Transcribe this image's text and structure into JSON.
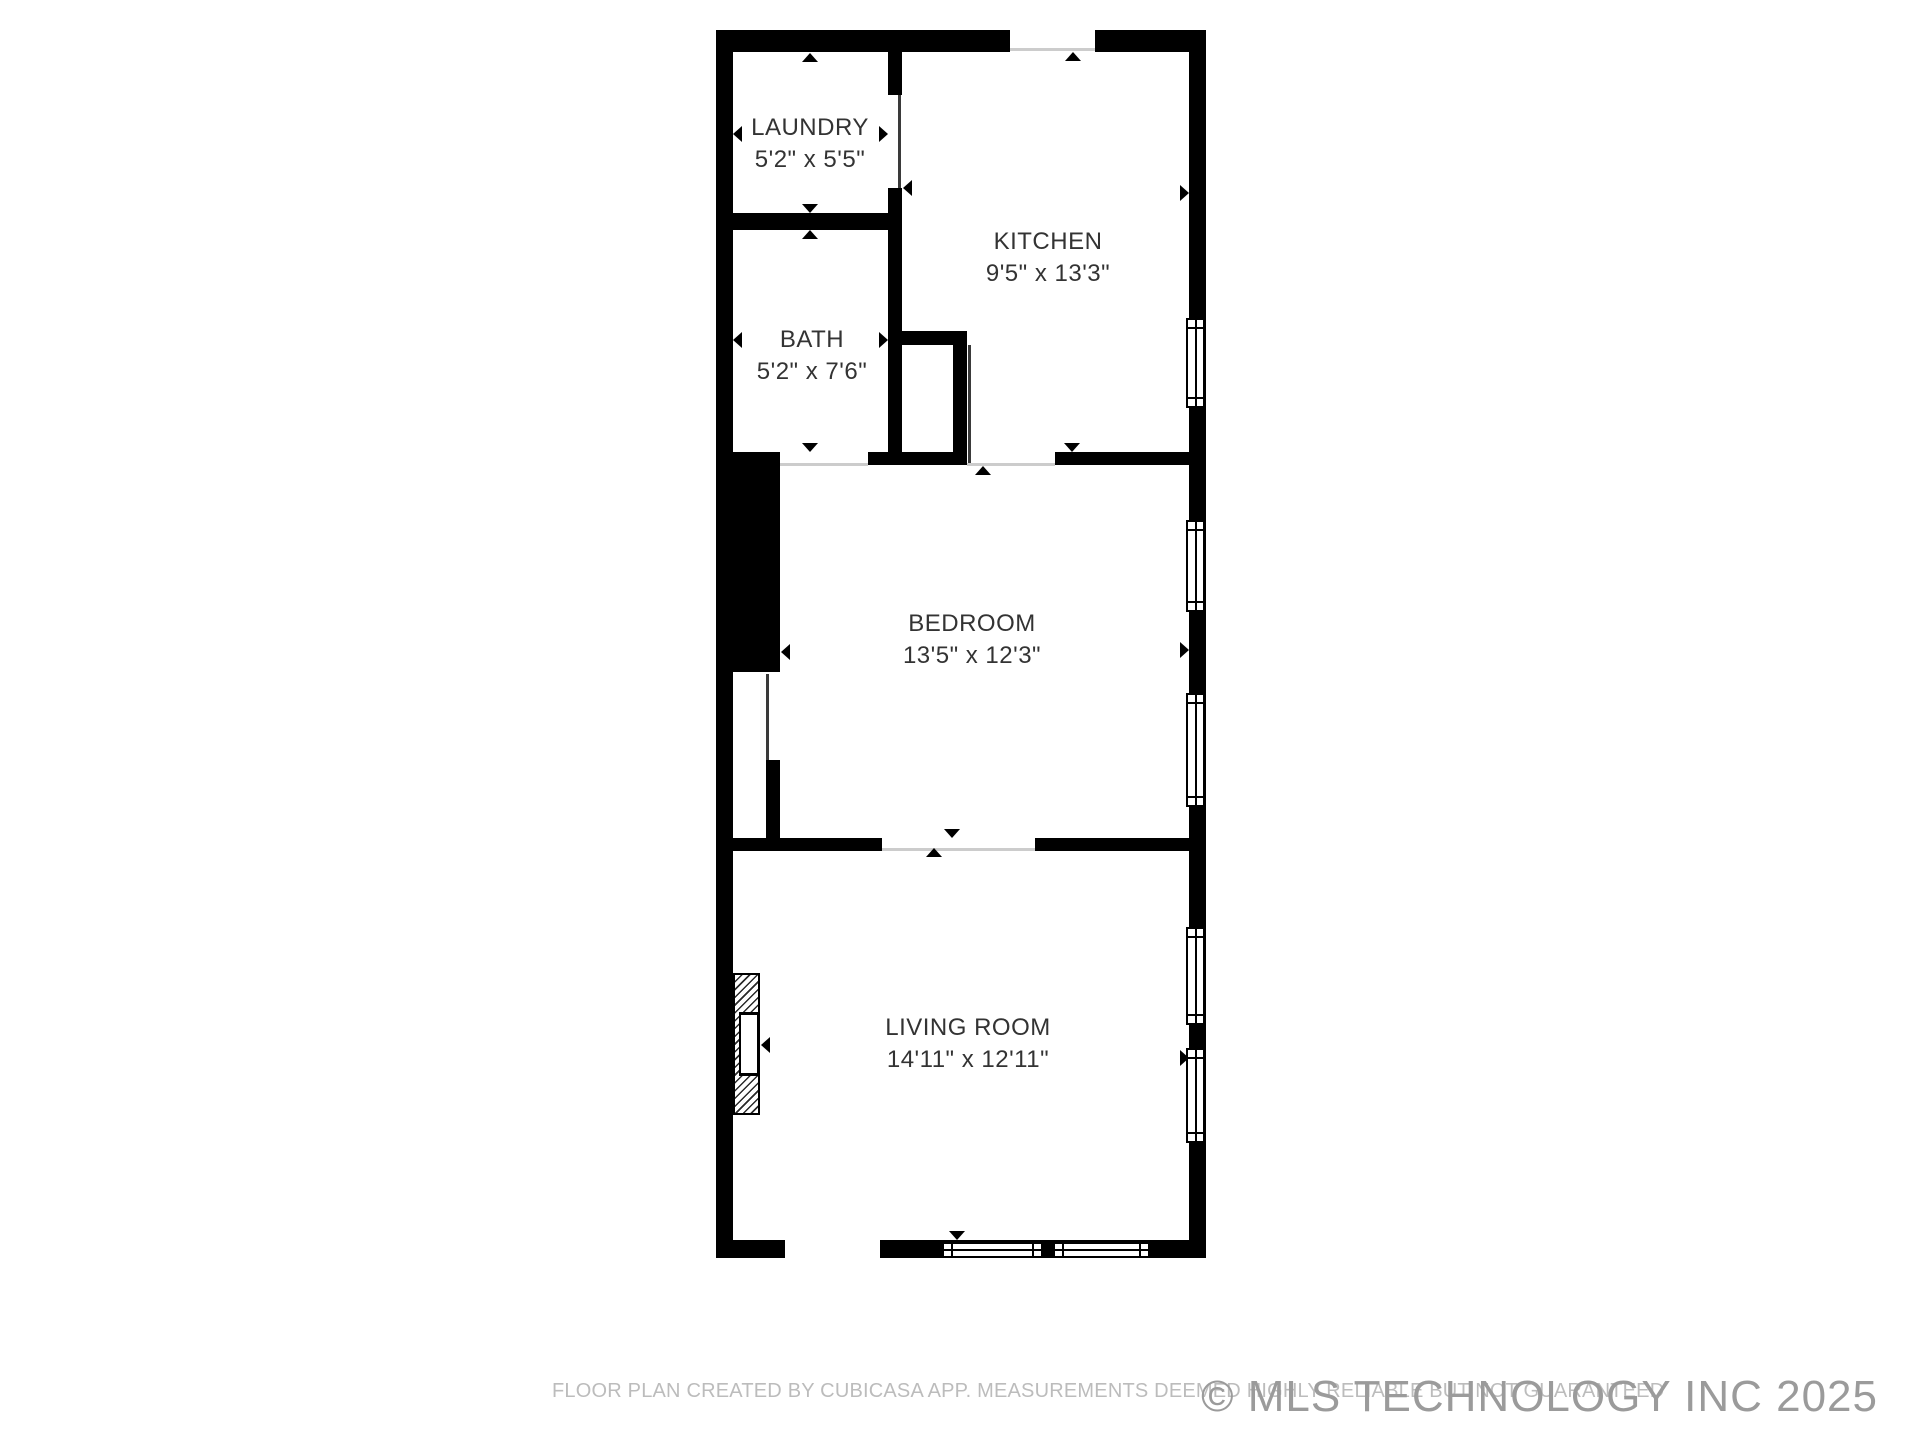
{
  "title": "Floor plan",
  "rooms": [
    {
      "name": "LAUNDRY",
      "dimensions": "5'2\" x 5'5\""
    },
    {
      "name": "KITCHEN",
      "dimensions": "9'5\" x 13'3\""
    },
    {
      "name": "BATH",
      "dimensions": "5'2\" x 7'6\""
    },
    {
      "name": "BEDROOM",
      "dimensions": "13'5\" x 12'3\""
    },
    {
      "name": "LIVING ROOM",
      "dimensions": "14'11\" x 12'11\""
    }
  ],
  "footer": {
    "disclaimer": "FLOOR PLAN CREATED BY CUBICASA APP. MEASUREMENTS DEEMED HIGHLY RELIABLE BUT NOT GUARANTEED",
    "watermark": "© MLS TECHNOLOGY INC 2025"
  },
  "colors": {
    "wall": "#000000",
    "background": "#ffffff",
    "room_label_text": "#333333",
    "opening_face_line": "#cccccc",
    "door_panel_line": "#3a3a3a",
    "disclaimer_text": "#bcbcbc",
    "watermark_text": "#9b9b9b"
  }
}
